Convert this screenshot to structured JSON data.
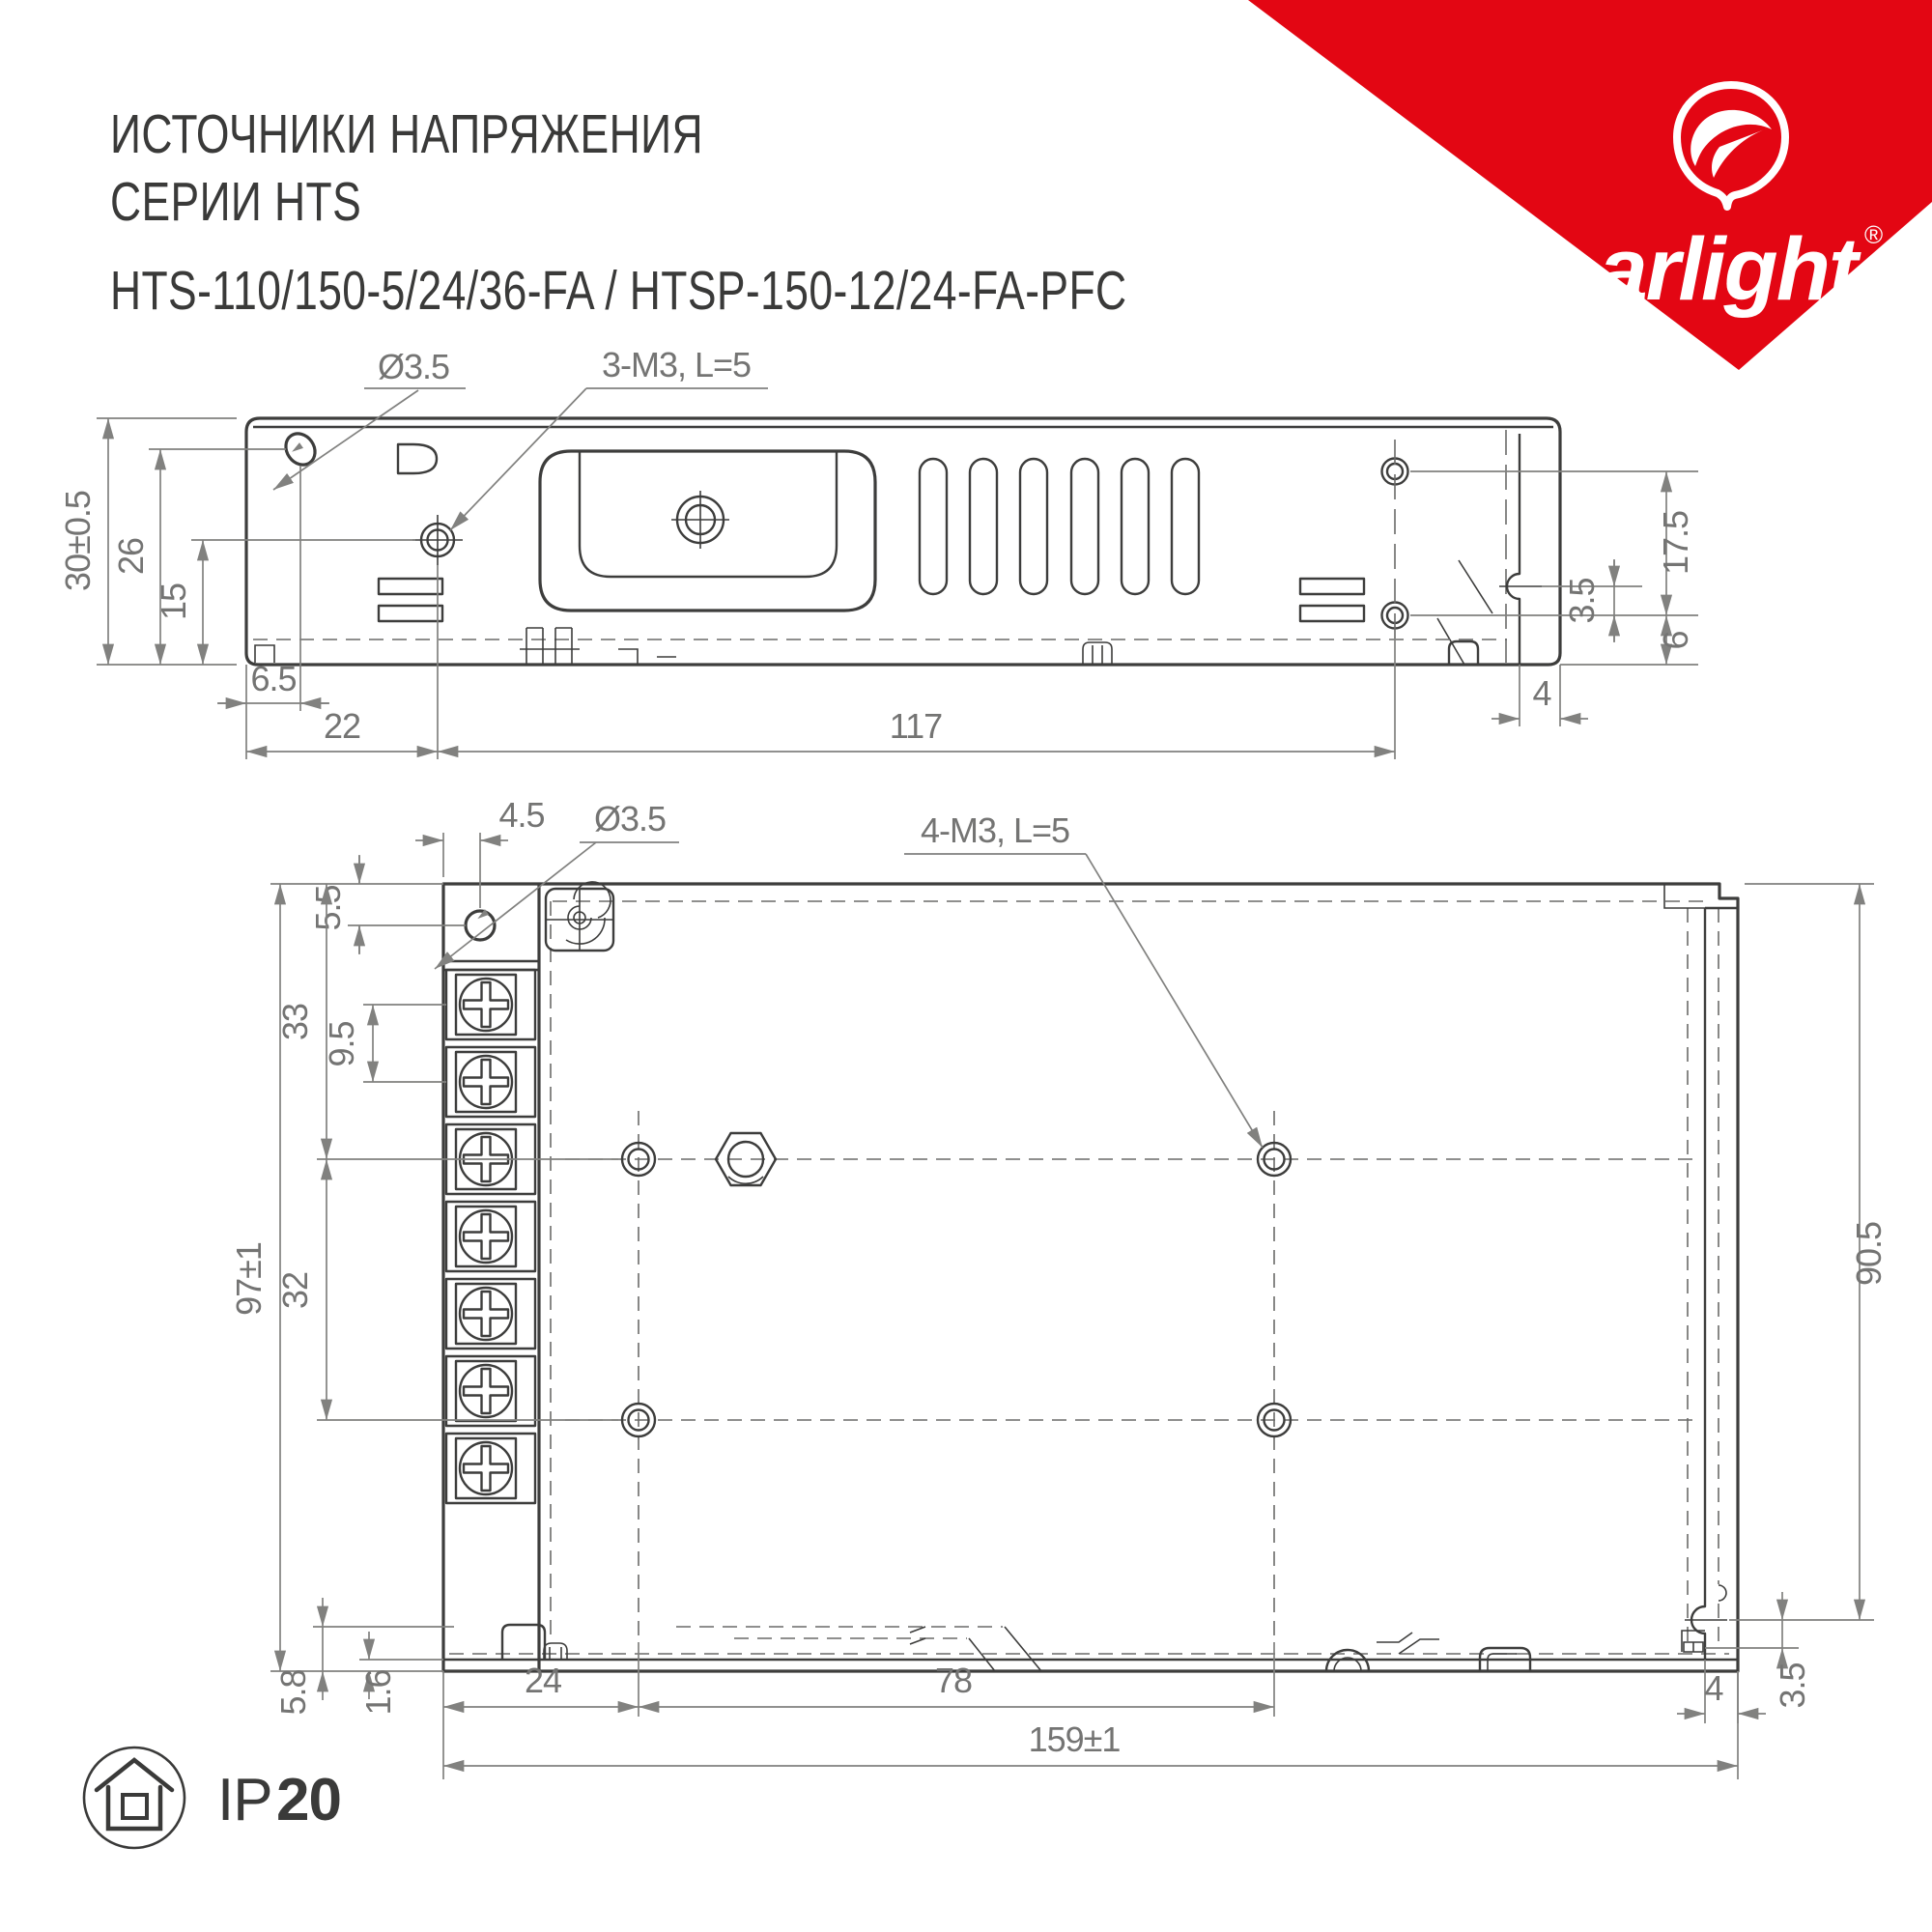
{
  "header": {
    "line1": "ИСТОЧНИКИ НАПРЯЖЕНИЯ",
    "line2": "СЕРИИ HTS",
    "line3": "HTS-110/150-5/24/36-FA / HTSP-150-12/24-FA-PFC"
  },
  "brand": {
    "wordmark": "arlight",
    "registered": "®",
    "triangle_color": "#E30613"
  },
  "side_view": {
    "labels": {
      "hole_dia": "Ø3.5",
      "screws": "3-M3, L=5"
    },
    "dims": {
      "height_total": "30±0.5",
      "hole_height": "26",
      "screw_height": "15",
      "hole_offset": "6.5",
      "screw_offset": "22",
      "screw_pitch": "117",
      "right_screw_span": "17.5",
      "slot_offset": "3.5",
      "bottom_screw_height": "6",
      "flange_depth": "4"
    }
  },
  "top_view": {
    "labels": {
      "hole_dia": "Ø3.5",
      "screws": "4-M3, L=5"
    },
    "dims": {
      "hole_offset_x": "4.5",
      "hole_offset_y": "5.5",
      "row1_offset": "33",
      "terminal_pitch": "9.5",
      "width_total": "97±1",
      "row_span": "32",
      "depth": "90.5",
      "foot_offset": "5.8",
      "wall_thickness": "1.6",
      "col1_offset": "24",
      "col_span": "78",
      "length_total": "159±1",
      "flange_depth": "4",
      "foot_height": "3.5"
    }
  },
  "footer": {
    "ip_prefix": "IP",
    "ip_value": "20"
  }
}
